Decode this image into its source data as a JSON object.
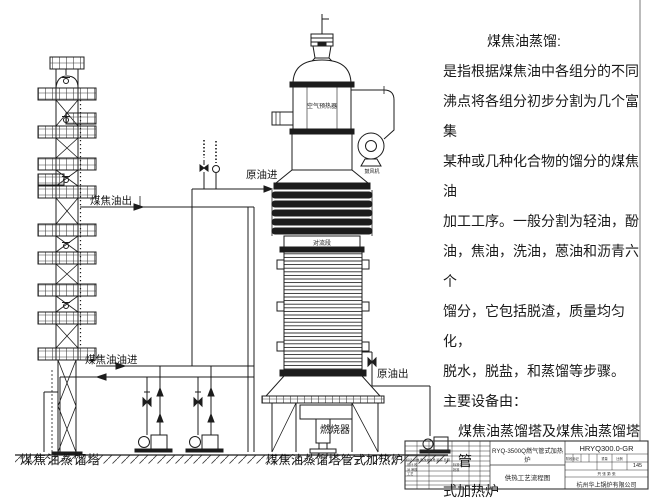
{
  "page": {
    "background": "#ffffff",
    "ink": "#1c1c1c"
  },
  "description": {
    "heading": "煤焦油蒸馏:",
    "lines": [
      "是指根据煤焦油中各组分的不同",
      "沸点将各组分初步分割为几个富集",
      "某种或几种化合物的馏分的煤焦油",
      "加工工序。一般分割为轻油，酚",
      "油，焦油，洗油，蒽油和沥青六个",
      "馏分，它包括脱渣，质量均匀化，",
      "脱水，脱盐，和蒸馏等步骤。"
    ],
    "equipment_heading": "主要设备由：",
    "equipment_lines": [
      "煤焦油蒸馏塔及煤焦油蒸馏塔管",
      "式加热炉"
    ]
  },
  "diagram_labels": {
    "tower_caption": "煤焦油蒸馏塔",
    "furnace_caption": "煤焦油蒸馏塔管式加热炉",
    "coal_tar_out": "煤焦油出",
    "coal_tar_oil_in": "煤焦油油进",
    "crude_oil_in": "原油进",
    "crude_oil_out": "原油出",
    "burner": "燃烧器",
    "air_preheater": "空气预热器",
    "convection_section": "对流段",
    "blower": "鼓风机"
  },
  "title_block": {
    "product_model": "RYQ-3500Q燃气管式加热炉",
    "document_title": "供热工艺流程图",
    "drawing_number": "HRYQ300.0-GR",
    "scale_value": "145",
    "stage_mark_label": "阶段标记",
    "weight_label": "重量",
    "scale_label": "比例",
    "sheet_label": "共 张 第 张",
    "rev_header": "标记 处数 更改文件号 签字 日期",
    "sign_column_1": "设计 校对 审核 工艺",
    "sign_column_2": "标准化 批准",
    "company": "杭州华上锅炉有限公司"
  }
}
